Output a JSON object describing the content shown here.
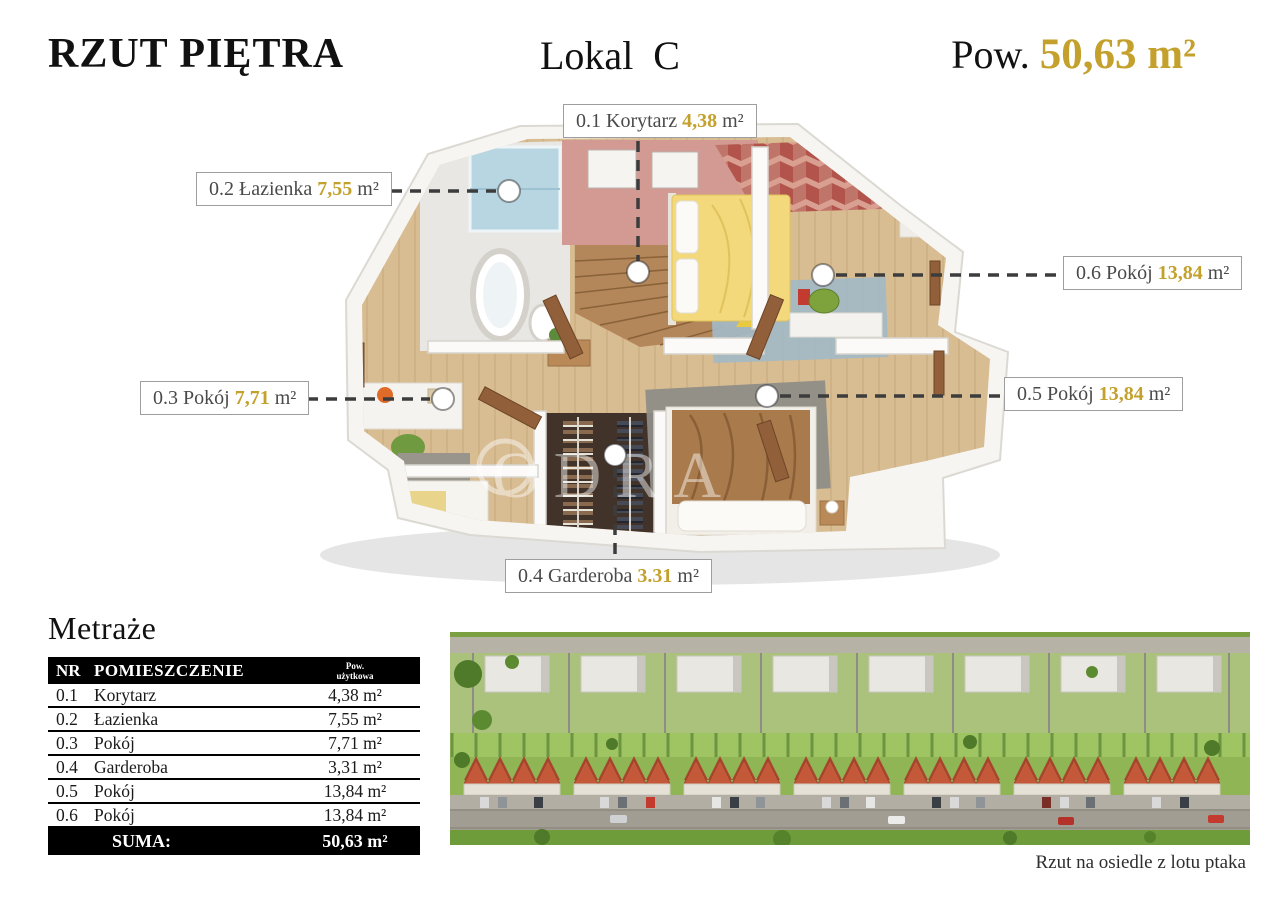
{
  "header": {
    "title": "RZUT PIĘTRA",
    "unit": "Lokal  C",
    "area_label": "Pow. ",
    "area_value": "50,63 m²"
  },
  "colors": {
    "accent_gold": "#C3A12C",
    "callout_dash": "#3C3C3C"
  },
  "plan": {
    "watermark": "ODRA",
    "labels": [
      {
        "prefix": "0.1 Korytarz",
        "value": "4,38",
        "suffix": "m²"
      },
      {
        "prefix": "0.2 Łazienka",
        "value": "7,55",
        "suffix": "m²"
      },
      {
        "prefix": "0.3 Pokój",
        "value": "7,71",
        "suffix": "m²"
      },
      {
        "prefix": "0.4 Garderoba",
        "value": "3.31",
        "suffix": "m²"
      },
      {
        "prefix": "0.5 Pokój",
        "value": "13,84",
        "suffix": "m²"
      },
      {
        "prefix": "0.6 Pokój",
        "value": "13,84",
        "suffix": "m²"
      }
    ]
  },
  "table": {
    "heading": "Metraże",
    "col_nr": "NR",
    "col_name": "POMIESZCZENIE",
    "col_area_line1": "Pow.",
    "col_area_line2": "użytkowa",
    "rows": [
      {
        "nr": "0.1",
        "name": "Korytarz",
        "area": "4,38 m²"
      },
      {
        "nr": "0.2",
        "name": "Łazienka",
        "area": "7,55 m²"
      },
      {
        "nr": "0.3",
        "name": "Pokój",
        "area": "7,71 m²"
      },
      {
        "nr": "0.4",
        "name": "Garderoba",
        "area": "3,31 m²"
      },
      {
        "nr": "0.5",
        "name": "Pokój",
        "area": "13,84 m²"
      },
      {
        "nr": "0.6",
        "name": "Pokój",
        "area": "13,84 m²"
      }
    ],
    "sum_label": "SUMA:",
    "sum_value": "50,63 m²"
  },
  "aerial": {
    "caption": "Rzut na osiedle z lotu ptaka"
  }
}
